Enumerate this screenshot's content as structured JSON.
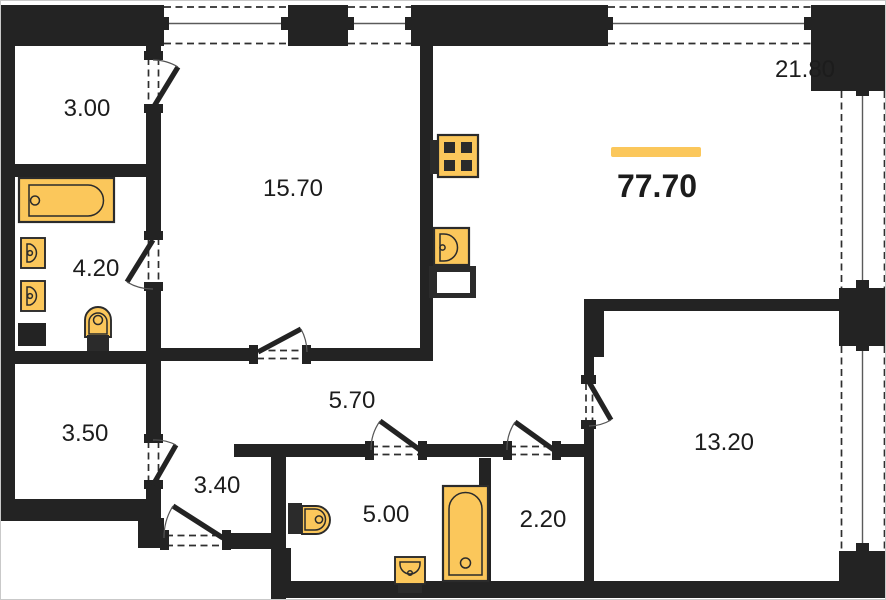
{
  "total": {
    "area": "77.70"
  },
  "rooms": {
    "storage_top": {
      "area": "3.00"
    },
    "bedroom": {
      "area": "15.70"
    },
    "living": {
      "area": "21.80"
    },
    "bathroom_main": {
      "area": "4.20"
    },
    "storage_bottom": {
      "area": "3.50"
    },
    "hallway": {
      "area": "5.70"
    },
    "corridor": {
      "area": "3.40"
    },
    "bathroom_second": {
      "area": "5.00"
    },
    "wardrobe": {
      "area": "2.20"
    },
    "bedroom_second": {
      "area": "13.20"
    }
  },
  "fixtures": [
    {
      "icon": "bathtub-icon",
      "room": "4.20"
    },
    {
      "icon": "sink-icon",
      "room": "4.20"
    },
    {
      "icon": "sink-icon",
      "room": "4.20"
    },
    {
      "icon": "toilet-icon",
      "room": "4.20"
    },
    {
      "icon": "stove-icon",
      "room": "21.80"
    },
    {
      "icon": "kitchen-sink-icon",
      "room": "21.80"
    },
    {
      "icon": "toilet-icon",
      "room": "5.00"
    },
    {
      "icon": "washbasin-icon",
      "room": "5.00"
    },
    {
      "icon": "bathtub-icon",
      "room": "5.00"
    }
  ],
  "colors": {
    "wall": "#232323",
    "fixture-fill": "#fbc75b",
    "fixture-stroke": "#2b2b2b",
    "accent": "#fbc75b",
    "line": "#2f2f2f",
    "text": "#1c1c1c",
    "bg": "#ffffff"
  }
}
